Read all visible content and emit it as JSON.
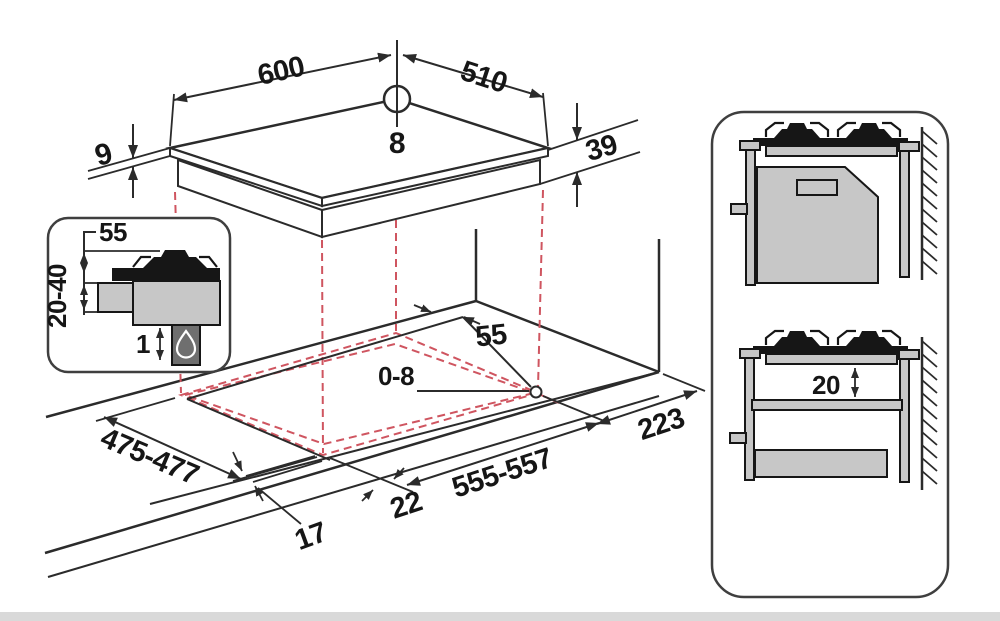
{
  "colors": {
    "line": "#2b2b2b",
    "black": "#161616",
    "red_dashed": "#cf5560",
    "gray_fill": "#c7c7c7",
    "flame_box": "#6f6f6f",
    "background": "#ffffff"
  },
  "main_view": {
    "hob": {
      "width": "600",
      "depth": "510",
      "glass_thickness": "9",
      "body_height": "39",
      "hole_offset": "8"
    },
    "cutout": {
      "width": "555-557",
      "depth": "475-477",
      "corner_radius": "0-8",
      "rear_clearance": "55",
      "right_clearance": "223",
      "front_offset": "17",
      "side_offset": "22"
    }
  },
  "detail_inset": {
    "pan_support_height": "55",
    "worktop_thickness": "20-40",
    "bottom_clearance": "1",
    "icon": "gas-flame"
  },
  "side_views": {
    "shelf_clearance": "20"
  }
}
